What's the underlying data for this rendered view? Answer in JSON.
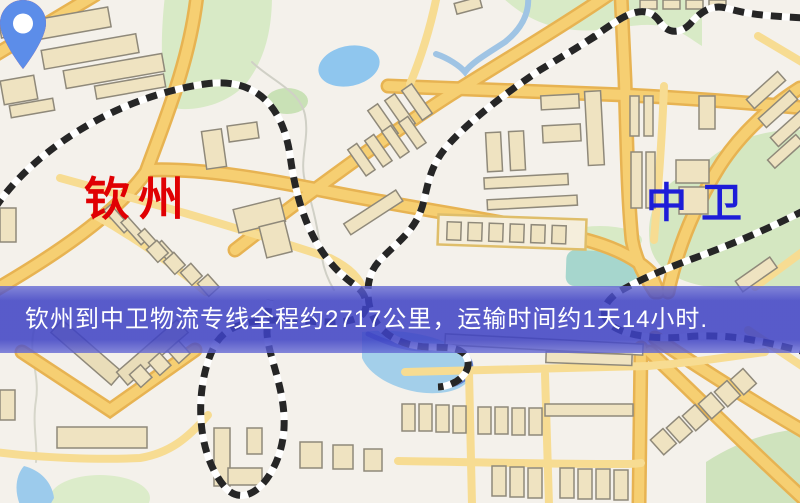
{
  "map": {
    "origin": {
      "name": "钦州",
      "pin_color": "#e8211e",
      "label_color": "#e00003",
      "pin_icon": "map-pin"
    },
    "destination": {
      "name": "中卫",
      "pin_color": "#5c8de9",
      "label_color": "#1d1dd8",
      "pin_icon": "map-pin"
    },
    "banner": {
      "text": "钦州到中卫物流专线全程约2717公里，运输时间约1天14小时.",
      "bg_color": "#4246c4",
      "text_color": "#ffffff"
    },
    "route": {
      "distance_km": "2717",
      "duration": "1天14小时"
    },
    "palette": {
      "background": "#f4f1eb",
      "road_core": "#f6cf72",
      "road_casing": "#e7b352",
      "building_fill": "#efe3c1",
      "green_area": "#d8eac6",
      "water": "#97cbec",
      "railway_dash": "#262626"
    }
  }
}
